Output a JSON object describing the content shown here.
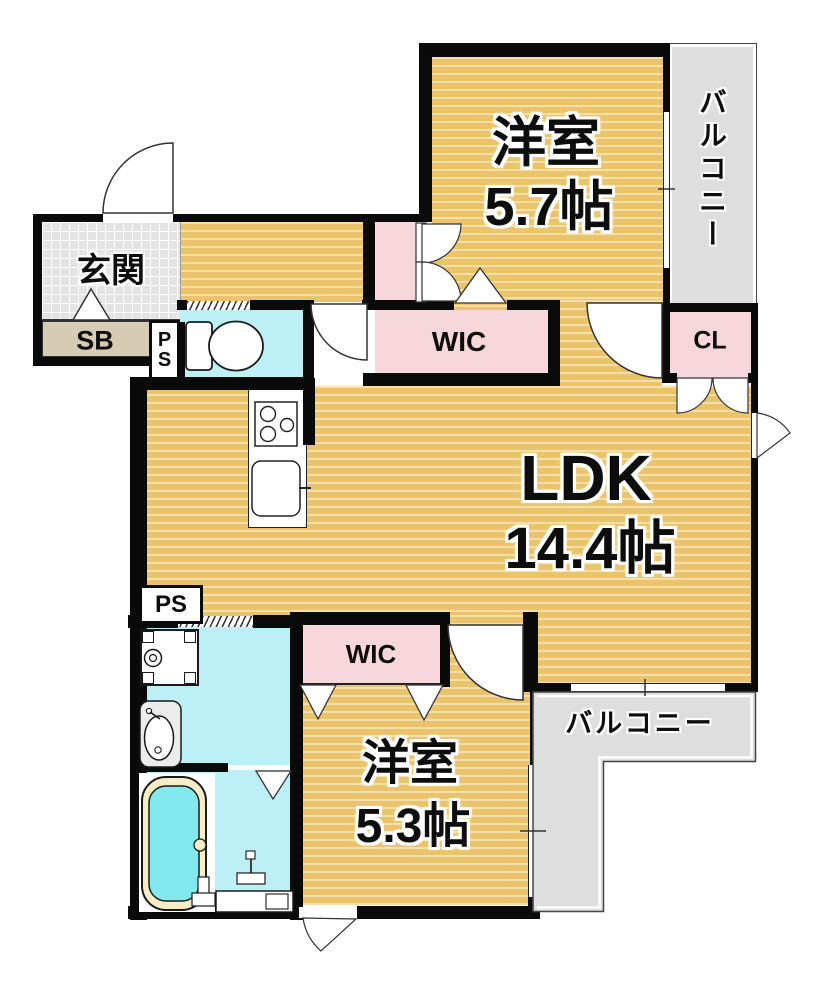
{
  "plan_type": "apartment-floor-plan",
  "rooms": {
    "genkan": {
      "name": "玄関"
    },
    "shoe_box": {
      "name": "SB"
    },
    "pipe_shaft_entrance": {
      "letters": [
        "P",
        "S"
      ]
    },
    "wic_top": {
      "name": "WIC"
    },
    "closet": {
      "name": "CL"
    },
    "western_room_57": {
      "name": "洋室",
      "size": "5.7帖"
    },
    "balcony_right": {
      "name": "バルコニー"
    },
    "ldk": {
      "name": "LDK",
      "size": "14.4帖"
    },
    "pipe_shaft_kitchen": {
      "name": "PS"
    },
    "wic_bottom": {
      "name": "WIC"
    },
    "western_room_53": {
      "name": "洋室",
      "size": "5.3帖"
    },
    "balcony_bottom": {
      "name": "バルコニー"
    }
  },
  "fixtures": [
    "entrance-door",
    "toilet",
    "kitchen-stove",
    "kitchen-sink",
    "washing-machine-pan",
    "washbasin",
    "bathtub",
    "shower-counter",
    "step-marker"
  ],
  "colors": {
    "wood_floor": "#eac46c",
    "closet_pink": "#f8d7dc",
    "water_cyan": "#bcf0f6",
    "balcony_gray": "#dedede",
    "entrance_tile": "#e4e4e4",
    "shoe_box_beige": "#d6ccb4",
    "wall": "#0a0a0a",
    "tub_rim": "#f6edc6",
    "tub_water": "#82e9ef"
  }
}
